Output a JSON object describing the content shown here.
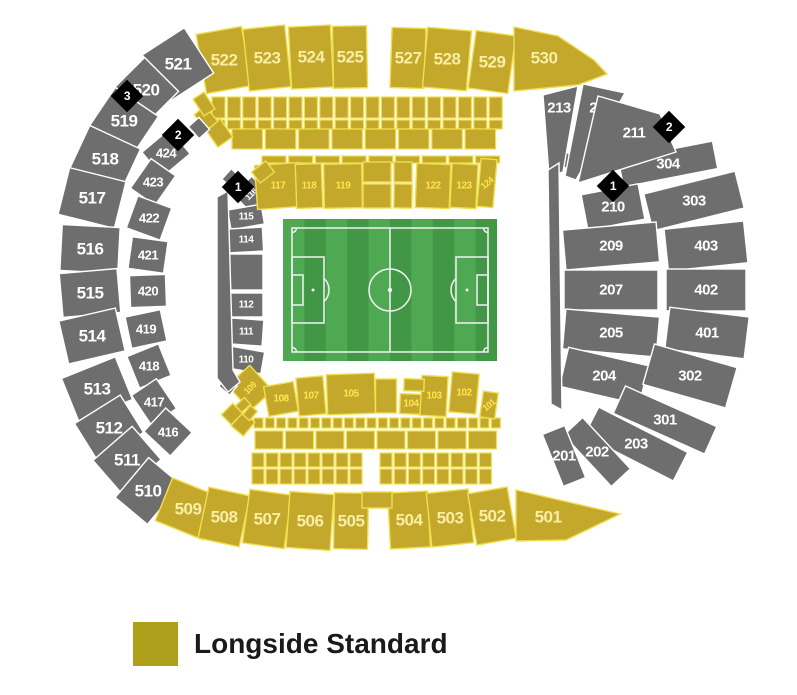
{
  "legend": {
    "label": "Longside Standard",
    "swatch_color": "#AFA01B"
  },
  "colors": {
    "gold": "#C3A82C",
    "goldStroke": "#F0DF4E",
    "goldTextBright": "#FFE54F",
    "goldTextPale": "#F9EFA4",
    "gray": "#6E6E6E",
    "grayStroke": "#FFFFFF",
    "grayText": "#FFFFFF",
    "marker": "#000000",
    "markerText": "#FFFFFF",
    "pitchLight": "#4FA852",
    "pitchDark": "#419746",
    "pitchLine": "#F2F2F2"
  },
  "pitch": {
    "x": 283,
    "y": 219,
    "w": 214,
    "h": 142,
    "stripes": 10,
    "inset": 9,
    "circle_r": 21,
    "pen_w": 32,
    "pen_h": 66,
    "goal_w": 11,
    "goal_h": 30,
    "arc_r": 16,
    "corner_r": 4.5
  },
  "markers": [
    {
      "id": "marker-3-west",
      "label": "3",
      "x": 127,
      "y": 96
    },
    {
      "id": "marker-2-west",
      "label": "2",
      "x": 178,
      "y": 135
    },
    {
      "id": "marker-1-west",
      "label": "1",
      "x": 238,
      "y": 187
    },
    {
      "id": "marker-2-east",
      "label": "2",
      "x": 669,
      "y": 127
    },
    {
      "id": "marker-1-east",
      "label": "1",
      "x": 613,
      "y": 186
    }
  ],
  "sections": [
    {
      "l": "522",
      "x": 224,
      "y": 60,
      "w": 46,
      "h": 60,
      "r": -10,
      "c": "gd",
      "fs": 17,
      "tc": "pale"
    },
    {
      "l": "523",
      "x": 267,
      "y": 58,
      "w": 42,
      "h": 62,
      "r": -6,
      "c": "gd",
      "fs": 17,
      "tc": "pale"
    },
    {
      "l": "524",
      "x": 311,
      "y": 57,
      "w": 42,
      "h": 62,
      "r": -3,
      "c": "gd",
      "fs": 17,
      "tc": "pale"
    },
    {
      "l": "525",
      "x": 350,
      "y": 57,
      "w": 34,
      "h": 62,
      "r": -1,
      "c": "gd",
      "fs": 17,
      "tc": "pale"
    },
    {
      "l": "527",
      "x": 408,
      "y": 58,
      "w": 34,
      "h": 60,
      "r": 2,
      "c": "gd",
      "fs": 17,
      "tc": "pale"
    },
    {
      "l": "528",
      "x": 447,
      "y": 59,
      "w": 44,
      "h": 60,
      "r": 5,
      "c": "gd",
      "fs": 17,
      "tc": "pale"
    },
    {
      "l": "529",
      "x": 492,
      "y": 62,
      "w": 40,
      "h": 58,
      "r": 8,
      "c": "gd",
      "fs": 17,
      "tc": "pale"
    },
    {
      "l": "521",
      "x": 178,
      "y": 64,
      "w": 50,
      "h": 54,
      "r": -33,
      "c": "gy",
      "fs": 17
    },
    {
      "l": "520",
      "x": 146,
      "y": 90,
      "w": 44,
      "h": 48,
      "r": -45,
      "c": "gy",
      "fs": 17
    },
    {
      "l": "519",
      "x": 124,
      "y": 121,
      "w": 46,
      "h": 52,
      "r": -56,
      "c": "gy",
      "fs": 17
    },
    {
      "l": "518",
      "x": 105,
      "y": 159,
      "w": 48,
      "h": 56,
      "r": -65,
      "c": "gy",
      "fs": 17
    },
    {
      "l": "517",
      "x": 92,
      "y": 198,
      "w": 48,
      "h": 58,
      "r": -76,
      "c": "gy",
      "fs": 17
    },
    {
      "l": "516",
      "x": 90,
      "y": 249,
      "w": 46,
      "h": 58,
      "r": -87,
      "c": "gy",
      "fs": 17
    },
    {
      "l": "515",
      "x": 90,
      "y": 293,
      "w": 44,
      "h": 58,
      "r": -95,
      "c": "gy",
      "fs": 17
    },
    {
      "l": "514",
      "x": 92,
      "y": 336,
      "w": 44,
      "h": 58,
      "r": -103,
      "c": "gy",
      "fs": 17
    },
    {
      "l": "513",
      "x": 97,
      "y": 389,
      "w": 46,
      "h": 58,
      "r": -112,
      "c": "gy",
      "fs": 17
    },
    {
      "l": "512",
      "x": 109,
      "y": 428,
      "w": 44,
      "h": 54,
      "r": -122,
      "c": "gy",
      "fs": 17
    },
    {
      "l": "511",
      "x": 127,
      "y": 460,
      "w": 44,
      "h": 52,
      "r": -131,
      "c": "gy",
      "fs": 17
    },
    {
      "l": "510",
      "x": 148,
      "y": 491,
      "w": 42,
      "h": 52,
      "r": -140,
      "c": "gy",
      "fs": 17
    },
    {
      "l": "509",
      "x": 188,
      "y": 509,
      "w": 52,
      "h": 46,
      "r": 22,
      "c": "gd",
      "fs": 17,
      "tc": "pale"
    },
    {
      "l": "508",
      "x": 224,
      "y": 517,
      "w": 42,
      "h": 52,
      "r": 12,
      "c": "gd",
      "fs": 17,
      "tc": "pale"
    },
    {
      "l": "507",
      "x": 267,
      "y": 519,
      "w": 42,
      "h": 54,
      "r": 8,
      "c": "gd",
      "fs": 17,
      "tc": "pale"
    },
    {
      "l": "506",
      "x": 310,
      "y": 521,
      "w": 44,
      "h": 56,
      "r": 4,
      "c": "gd",
      "fs": 17,
      "tc": "pale"
    },
    {
      "l": "505",
      "x": 351,
      "y": 521,
      "w": 34,
      "h": 56,
      "r": 1,
      "c": "gd",
      "fs": 17,
      "tc": "pale"
    },
    {
      "l": "504",
      "x": 409,
      "y": 520,
      "w": 40,
      "h": 56,
      "r": -3,
      "c": "gd",
      "fs": 17,
      "tc": "pale"
    },
    {
      "l": "503",
      "x": 450,
      "y": 518,
      "w": 42,
      "h": 54,
      "r": -6,
      "c": "gd",
      "fs": 17,
      "tc": "pale"
    },
    {
      "l": "502",
      "x": 492,
      "y": 516,
      "w": 40,
      "h": 52,
      "r": -10,
      "c": "gd",
      "fs": 17,
      "tc": "pale"
    },
    {
      "l": "424",
      "x": 166,
      "y": 153,
      "w": 36,
      "h": 32,
      "r": -40,
      "c": "gy",
      "fs": 13
    },
    {
      "l": "423",
      "x": 153,
      "y": 182,
      "w": 36,
      "h": 30,
      "r": -55,
      "c": "gy",
      "fs": 13
    },
    {
      "l": "422",
      "x": 149,
      "y": 218,
      "w": 34,
      "h": 36,
      "r": -70,
      "c": "gy",
      "fs": 13
    },
    {
      "l": "421",
      "x": 148,
      "y": 255,
      "w": 32,
      "h": 36,
      "r": -82,
      "c": "gy",
      "fs": 13
    },
    {
      "l": "420",
      "x": 148,
      "y": 291,
      "w": 32,
      "h": 36,
      "r": -92,
      "c": "gy",
      "fs": 13
    },
    {
      "l": "419",
      "x": 146,
      "y": 329,
      "w": 32,
      "h": 36,
      "r": -102,
      "c": "gy",
      "fs": 13
    },
    {
      "l": "418",
      "x": 149,
      "y": 366,
      "w": 34,
      "h": 34,
      "r": -112,
      "c": "gy",
      "fs": 13
    },
    {
      "l": "417",
      "x": 154,
      "y": 402,
      "w": 36,
      "h": 30,
      "r": -124,
      "c": "gy",
      "fs": 13
    },
    {
      "l": "416",
      "x": 168,
      "y": 432,
      "w": 36,
      "h": 32,
      "r": -137,
      "c": "gy",
      "fs": 13
    },
    {
      "l": "304",
      "x": 668,
      "y": 164,
      "w": 96,
      "h": 28,
      "r": -11,
      "c": "gy",
      "fs": 15
    },
    {
      "l": "303",
      "x": 694,
      "y": 201,
      "w": 94,
      "h": 38,
      "r": -14,
      "c": "gy",
      "fs": 15
    },
    {
      "l": "210",
      "x": 613,
      "y": 207,
      "w": 58,
      "h": 36,
      "r": -11,
      "c": "gy",
      "fs": 15
    },
    {
      "l": "209",
      "x": 611,
      "y": 246,
      "w": 94,
      "h": 40,
      "r": -5,
      "c": "gy",
      "fs": 15
    },
    {
      "l": "403",
      "x": 706,
      "y": 246,
      "w": 80,
      "h": 42,
      "r": -6,
      "c": "gy",
      "fs": 15
    },
    {
      "l": "207",
      "x": 611,
      "y": 290,
      "w": 94,
      "h": 40,
      "r": 0,
      "c": "gy",
      "fs": 15
    },
    {
      "l": "402",
      "x": 706,
      "y": 290,
      "w": 80,
      "h": 42,
      "r": 0,
      "c": "gy",
      "fs": 15
    },
    {
      "l": "205",
      "x": 611,
      "y": 333,
      "w": 94,
      "h": 40,
      "r": 5,
      "c": "gy",
      "fs": 15
    },
    {
      "l": "401",
      "x": 707,
      "y": 333,
      "w": 80,
      "h": 42,
      "r": 7,
      "c": "gy",
      "fs": 15
    },
    {
      "l": "204",
      "x": 604,
      "y": 376,
      "w": 82,
      "h": 40,
      "r": 13,
      "c": "gy",
      "fs": 15
    },
    {
      "l": "302",
      "x": 690,
      "y": 376,
      "w": 86,
      "h": 42,
      "r": 16,
      "c": "gy",
      "fs": 15
    },
    {
      "l": "301",
      "x": 665,
      "y": 420,
      "w": 100,
      "h": 30,
      "r": 24,
      "c": "gy",
      "fs": 15
    },
    {
      "l": "203",
      "x": 636,
      "y": 444,
      "w": 100,
      "h": 32,
      "r": 27,
      "c": "gy",
      "fs": 15
    },
    {
      "l": "202",
      "x": 597,
      "y": 452,
      "w": 70,
      "h": 26,
      "r": 47,
      "c": "gy",
      "fs": 15
    },
    {
      "l": "201",
      "x": 564,
      "y": 456,
      "w": 56,
      "h": 24,
      "r": 68,
      "c": "gy",
      "fs": 15
    },
    {
      "l": "116",
      "x": 251,
      "y": 194,
      "w": 26,
      "h": 24,
      "r": -45,
      "c": "gy",
      "fs": 9,
      "lr": -45
    },
    {
      "l": "115",
      "x": 246,
      "y": 217,
      "w": 34,
      "h": 20,
      "r": -10,
      "c": "gy",
      "fs": 10
    },
    {
      "l": "114",
      "x": 246,
      "y": 240,
      "w": 34,
      "h": 24,
      "r": -3,
      "c": "gy",
      "fs": 10
    },
    {
      "x": 246,
      "y": 272,
      "w": 34,
      "h": 36,
      "r": 0,
      "c": "gy"
    },
    {
      "l": "112",
      "x": 246,
      "y": 305,
      "w": 34,
      "h": 24,
      "r": 0,
      "c": "gy",
      "fs": 10
    },
    {
      "l": "111",
      "x": 246,
      "y": 332,
      "w": 34,
      "h": 26,
      "r": 4,
      "c": "gy",
      "fs": 10
    },
    {
      "l": "110",
      "x": 246,
      "y": 360,
      "w": 34,
      "h": 22,
      "r": 10,
      "c": "gy",
      "fs": 10
    },
    {
      "l": "117",
      "x": 278,
      "y": 186,
      "w": 44,
      "h": 44,
      "r": -4,
      "c": "gd",
      "fs": 10
    },
    {
      "l": "118",
      "x": 309,
      "y": 186,
      "w": 26,
      "h": 44,
      "r": -2,
      "c": "gd",
      "fs": 10
    },
    {
      "l": "119",
      "x": 343,
      "y": 186,
      "w": 38,
      "h": 44,
      "r": -1,
      "c": "gd",
      "fs": 10
    },
    {
      "l": "122",
      "x": 433,
      "y": 186,
      "w": 34,
      "h": 44,
      "r": 2,
      "c": "gd",
      "fs": 10
    },
    {
      "l": "123",
      "x": 464,
      "y": 186,
      "w": 26,
      "h": 44,
      "r": 3,
      "c": "gd",
      "fs": 10
    },
    {
      "l": "124",
      "x": 487,
      "y": 183,
      "w": 16,
      "h": 48,
      "r": 5,
      "c": "gd",
      "fs": 9,
      "lr": -40
    },
    {
      "l": "109",
      "x": 250,
      "y": 388,
      "w": 30,
      "h": 34,
      "r": -42,
      "c": "gd",
      "fs": 9,
      "lr": -45
    },
    {
      "l": "108",
      "x": 281,
      "y": 399,
      "w": 30,
      "h": 30,
      "r": -10,
      "c": "gd",
      "fs": 10
    },
    {
      "l": "107",
      "x": 311,
      "y": 396,
      "w": 27,
      "h": 38,
      "r": -5,
      "c": "gd",
      "fs": 10
    },
    {
      "l": "105",
      "x": 351,
      "y": 394,
      "w": 48,
      "h": 40,
      "r": -2,
      "c": "gd",
      "fs": 10
    },
    {
      "l": "104",
      "x": 411,
      "y": 404,
      "w": 22,
      "h": 20,
      "r": 2,
      "c": "gd",
      "fs": 10
    },
    {
      "l": "103",
      "x": 434,
      "y": 396,
      "w": 26,
      "h": 40,
      "r": 3,
      "c": "gd",
      "fs": 10
    },
    {
      "l": "102",
      "x": 464,
      "y": 393,
      "w": 27,
      "h": 40,
      "r": 5,
      "c": "gd",
      "fs": 10
    },
    {
      "l": "101",
      "x": 489,
      "y": 405,
      "w": 15,
      "h": 26,
      "r": 8,
      "c": "gd",
      "fs": 9,
      "lr": -40
    },
    {
      "x": 377,
      "y": 172,
      "w": 28,
      "h": 20,
      "r": 0,
      "c": "gd"
    },
    {
      "x": 377,
      "y": 196,
      "w": 28,
      "h": 24,
      "r": 0,
      "c": "gd"
    },
    {
      "x": 403,
      "y": 172,
      "w": 18,
      "h": 20,
      "r": 0,
      "c": "gd"
    },
    {
      "x": 403,
      "y": 196,
      "w": 18,
      "h": 24,
      "r": 1,
      "c": "gd"
    },
    {
      "x": 386,
      "y": 396,
      "w": 21,
      "h": 34,
      "r": 0,
      "c": "gd"
    },
    {
      "x": 414,
      "y": 385,
      "w": 20,
      "h": 12,
      "r": 2,
      "c": "gd"
    },
    {
      "x": 377,
      "y": 500,
      "w": 30,
      "h": 16,
      "r": 0,
      "c": "gd"
    },
    {
      "x": 263,
      "y": 172,
      "w": 18,
      "h": 14,
      "r": -38,
      "c": "gd"
    },
    {
      "x": 219,
      "y": 133,
      "w": 18,
      "h": 22,
      "r": -35,
      "c": "gd"
    },
    {
      "x": 206,
      "y": 118,
      "w": 14,
      "h": 20,
      "r": -40,
      "c": "gd"
    },
    {
      "x": 204,
      "y": 104,
      "w": 13,
      "h": 20,
      "r": -33,
      "c": "gd"
    },
    {
      "x": 243,
      "y": 424,
      "w": 16,
      "h": 18,
      "r": 40,
      "c": "gd"
    },
    {
      "x": 232,
      "y": 414,
      "w": 14,
      "h": 16,
      "r": 45,
      "c": "gd"
    },
    {
      "x": 243,
      "y": 405,
      "w": 9,
      "h": 12,
      "r": 48,
      "c": "gd"
    },
    {
      "x": 250,
      "y": 413,
      "w": 9,
      "h": 12,
      "r": 40,
      "c": "gd"
    },
    {
      "x": 231,
      "y": 178,
      "w": 14,
      "h": 12,
      "r": -48,
      "c": "gy"
    },
    {
      "x": 228,
      "y": 386,
      "w": 14,
      "h": 12,
      "r": 40,
      "c": "gy"
    },
    {
      "x": 199,
      "y": 128,
      "w": 14,
      "h": 16,
      "r": -42,
      "c": "gy"
    },
    {
      "x": 566,
      "y": 160,
      "w": 22,
      "h": 14,
      "r": 32,
      "c": "gy"
    }
  ],
  "polys": [
    {
      "l": "530",
      "points": "514,27 558,36 594,60 607,74 578,85 514,91",
      "c": "gd",
      "lx": 544,
      "ly": 58,
      "fs": 17,
      "tc": "pale"
    },
    {
      "l": "501",
      "points": "516,490 620,514 566,540 516,541",
      "c": "gd",
      "lx": 548,
      "ly": 517,
      "fs": 17,
      "tc": "pale"
    },
    {
      "l": "213",
      "points": "543,95 578,86 563,172 549,176",
      "c": "gy",
      "lx": 559,
      "ly": 108,
      "fs": 15
    },
    {
      "l": "212",
      "points": "583,84 625,93 576,180 565,176",
      "c": "gy",
      "lx": 601,
      "ly": 108,
      "fs": 15
    },
    {
      "l": "211",
      "points": "598,96 660,114 676,152 578,183",
      "c": "gy",
      "lx": 634,
      "ly": 133,
      "fs": 15
    },
    {
      "points": "217,197 228,191 233,370 240,382 228,392 217,378",
      "c": "gy"
    },
    {
      "points": "548,170 559,163 562,410 551,404",
      "c": "gy"
    }
  ],
  "block_rows": [
    {
      "x": 212,
      "y": 97,
      "w": 13,
      "h": 21,
      "count": 19,
      "gap": 2.4,
      "c": "gd"
    },
    {
      "x": 212,
      "y": 120,
      "w": 13,
      "h": 9,
      "count": 19,
      "gap": 2.4,
      "c": "gd"
    },
    {
      "x": 232,
      "y": 129,
      "w": 30.5,
      "h": 20,
      "count": 8,
      "gap": 2.8,
      "c": "gd"
    },
    {
      "x": 262,
      "y": 156,
      "w": 24,
      "h": 7,
      "count": 9,
      "gap": 2.7,
      "c": "gd"
    },
    {
      "x": 254,
      "y": 418,
      "w": 9,
      "h": 10,
      "count": 22,
      "gap": 2.3,
      "c": "gd"
    },
    {
      "x": 255,
      "y": 431,
      "w": 28,
      "h": 18,
      "count": 8,
      "gap": 2.5,
      "c": "gd"
    },
    {
      "x": 252,
      "y": 453,
      "w": 12,
      "h": 14,
      "count": 8,
      "gap": 2,
      "c": "gd"
    },
    {
      "x": 380,
      "y": 453,
      "w": 12,
      "h": 14,
      "count": 8,
      "gap": 2.2,
      "c": "gd"
    },
    {
      "x": 252,
      "y": 469,
      "w": 12,
      "h": 15,
      "count": 8,
      "gap": 2,
      "c": "gd"
    },
    {
      "x": 380,
      "y": 469,
      "w": 12,
      "h": 15,
      "count": 8,
      "gap": 2.2,
      "c": "gd"
    }
  ]
}
